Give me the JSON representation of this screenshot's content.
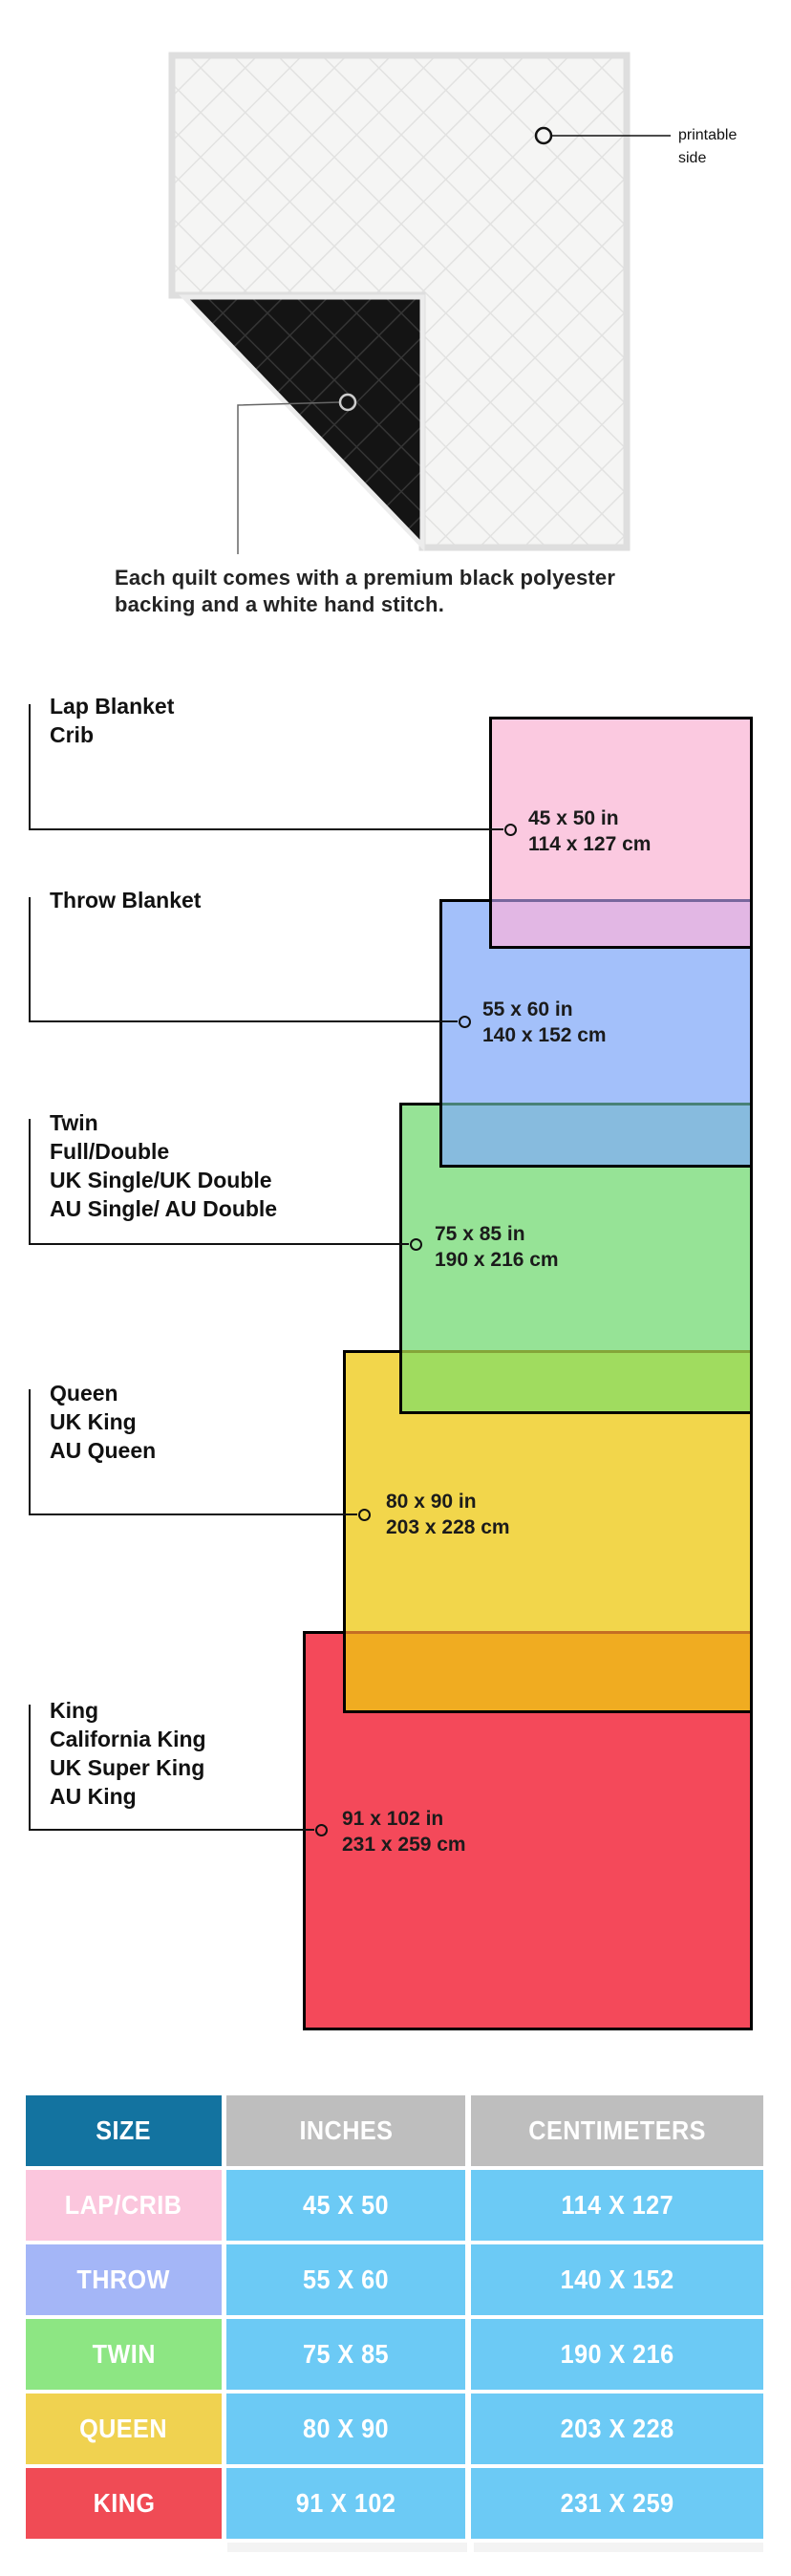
{
  "quilt": {
    "printable_label": "printable side",
    "caption": "Each quilt comes with a premium black polyester backing and a white hand stitch."
  },
  "diagram": {
    "sizes": [
      {
        "id": "lap",
        "labels": [
          "Lap Blanket",
          "Crib"
        ],
        "dim_in": "45 x 50 in",
        "dim_cm": "114 x 127 cm",
        "color": "#FBC9E0",
        "overlap_color": "#E2B7E4"
      },
      {
        "id": "throw",
        "labels": [
          "Throw Blanket"
        ],
        "dim_in": "55 x 60 in",
        "dim_cm": "140 x 152 cm",
        "color": "#A3C0FA",
        "overlap_color": "#87BBDE"
      },
      {
        "id": "twin",
        "labels": [
          "Twin",
          "Full/Double",
          "UK Single/UK Double",
          "AU Single/ AU Double"
        ],
        "dim_in": "75 x 85 in",
        "dim_cm": "190 x 216 cm",
        "color": "#96E396",
        "overlap_color": "#A0DC5F"
      },
      {
        "id": "queen",
        "labels": [
          "Queen",
          "UK King",
          "AU Queen"
        ],
        "dim_in": "80 x 90 in",
        "dim_cm": "203 x 228 cm",
        "color": "#F2D64B",
        "overlap_color": "#F0AC21"
      },
      {
        "id": "king",
        "labels": [
          "King",
          "California King",
          "UK Super King",
          "AU King"
        ],
        "dim_in": "91 x 102 in",
        "dim_cm": "231 x 259 cm",
        "color": "#F4495A"
      }
    ]
  },
  "table": {
    "headers": [
      "SIZE",
      "INCHES",
      "CENTIMETERS"
    ],
    "header_colors": {
      "size_bg": "#1373A0",
      "other_bg": "#BEBEBE",
      "cell_bg": "#6CCAF5"
    },
    "rows": [
      {
        "size": "LAP/CRIB",
        "inches": "45 X 50",
        "centimeters": "114 X 127",
        "color": "#FBC6DD"
      },
      {
        "size": "THROW",
        "inches": "55 X 60",
        "centimeters": "140 X 152",
        "color": "#A4B6F7"
      },
      {
        "size": "TWIN",
        "inches": "75 X 85",
        "centimeters": "190 X 216",
        "color": "#8DE683"
      },
      {
        "size": "QUEEN",
        "inches": "80 X 90",
        "centimeters": "203 X 228",
        "color": "#F0D250"
      },
      {
        "size": "KING",
        "inches": "91 X 102",
        "centimeters": "231 X 259",
        "color": "#F04B55"
      }
    ]
  }
}
